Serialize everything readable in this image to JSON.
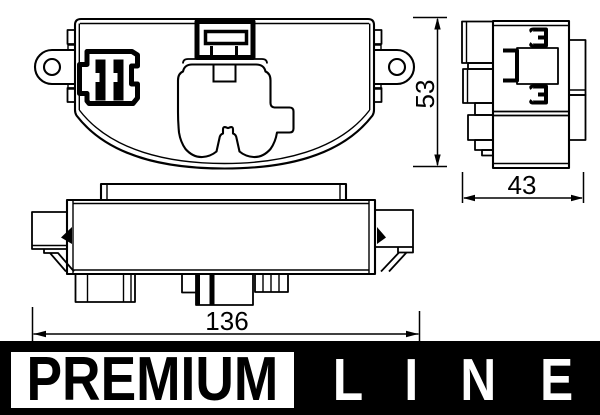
{
  "drawing": {
    "dimensions": {
      "height": "53",
      "depth": "43",
      "width": "136"
    }
  },
  "brand": {
    "premium_label": "PREMIUM",
    "line_letters": [
      "L",
      "I",
      "N",
      "E"
    ]
  },
  "colors": {
    "ink": "#000000",
    "paper": "#ffffff",
    "banner_bg": "#000000",
    "banner_fg": "#ffffff"
  }
}
